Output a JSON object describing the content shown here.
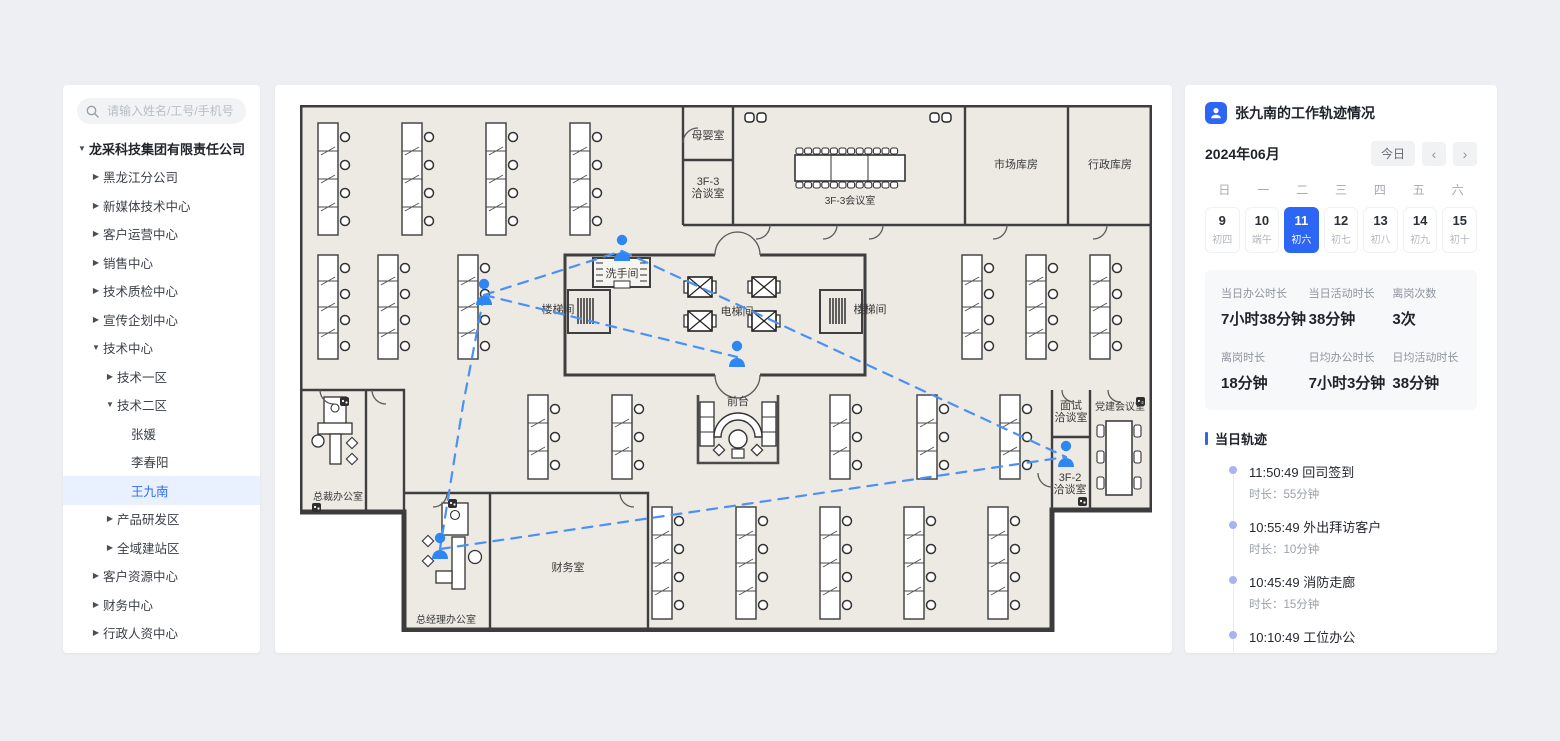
{
  "colors": {
    "accent": "#2d66f5",
    "path_blue": "#4a90f5",
    "marker_blue": "#2e86f2",
    "timeline_dot": "#a9b3f3",
    "floor_fill": "#eceae3",
    "wall": "#3c3c3c"
  },
  "sidebar": {
    "search_placeholder": "请输入姓名/工号/手机号",
    "tree": [
      {
        "label": "龙采科技集团有限责任公司",
        "level": 0,
        "state": "expanded",
        "selected": false
      },
      {
        "label": "黑龙江分公司",
        "level": 1,
        "state": "collapsed",
        "selected": false
      },
      {
        "label": "新媒体技术中心",
        "level": 1,
        "state": "collapsed",
        "selected": false
      },
      {
        "label": "客户运营中心",
        "level": 1,
        "state": "collapsed",
        "selected": false
      },
      {
        "label": "销售中心",
        "level": 1,
        "state": "collapsed",
        "selected": false
      },
      {
        "label": "技术质检中心",
        "level": 1,
        "state": "collapsed",
        "selected": false
      },
      {
        "label": "宣传企划中心",
        "level": 1,
        "state": "collapsed",
        "selected": false
      },
      {
        "label": "技术中心",
        "level": 1,
        "state": "expanded",
        "selected": false
      },
      {
        "label": "技术一区",
        "level": 2,
        "state": "collapsed",
        "selected": false
      },
      {
        "label": "技术二区",
        "level": 2,
        "state": "expanded",
        "selected": false
      },
      {
        "label": "张媛",
        "level": 3,
        "state": "leaf",
        "selected": false
      },
      {
        "label": "李春阳",
        "level": 3,
        "state": "leaf",
        "selected": false
      },
      {
        "label": "王九南",
        "level": 3,
        "state": "leaf",
        "selected": true
      },
      {
        "label": "产品研发区",
        "level": 2,
        "state": "collapsed",
        "selected": false
      },
      {
        "label": "全域建站区",
        "level": 2,
        "state": "collapsed",
        "selected": false
      },
      {
        "label": "客户资源中心",
        "level": 1,
        "state": "collapsed",
        "selected": false
      },
      {
        "label": "财务中心",
        "level": 1,
        "state": "collapsed",
        "selected": false
      },
      {
        "label": "行政人资中心",
        "level": 1,
        "state": "collapsed",
        "selected": false
      }
    ]
  },
  "floorplan": {
    "rooms": [
      {
        "label": "母婴室",
        "x": 408,
        "y": 34
      },
      {
        "label": "3F-3",
        "label2": "洽谈室",
        "x": 408,
        "y": 80
      },
      {
        "label": "3F-3会议室",
        "x": 550,
        "y": 99
      },
      {
        "label": "市场库房",
        "x": 716,
        "y": 63
      },
      {
        "label": "行政库房",
        "x": 810,
        "y": 63
      },
      {
        "label": "洗手间",
        "x": 322,
        "y": 172
      },
      {
        "label": "楼梯间",
        "x": 258,
        "y": 208
      },
      {
        "label": "电梯间",
        "x": 437,
        "y": 210
      },
      {
        "label": "楼梯间",
        "x": 570,
        "y": 208
      },
      {
        "label": "前台",
        "x": 438,
        "y": 300
      },
      {
        "label": "总裁办公室",
        "x": 38,
        "y": 395
      },
      {
        "label": "总经理办公室",
        "x": 146,
        "y": 518
      },
      {
        "label": "财务室",
        "x": 268,
        "y": 466
      },
      {
        "label": "面试",
        "label2": "洽谈室",
        "x": 771,
        "y": 304
      },
      {
        "label": "党建会议室",
        "x": 820,
        "y": 305
      },
      {
        "label": "3F-2",
        "label2": "洽谈室",
        "x": 770,
        "y": 376
      }
    ],
    "trajectory": {
      "points": {
        "A": {
          "x": 184,
          "y": 190
        },
        "B": {
          "x": 322,
          "y": 146
        },
        "C": {
          "x": 437,
          "y": 252
        },
        "D": {
          "x": 140,
          "y": 444
        },
        "E": {
          "x": 766,
          "y": 352
        }
      },
      "segments": [
        {
          "from": "A",
          "to": "B"
        },
        {
          "from": "B",
          "to": "E"
        },
        {
          "from": "A",
          "to": "C"
        },
        {
          "from": "A",
          "to": "D",
          "via": [
            [
              163,
              300
            ]
          ]
        },
        {
          "from": "D",
          "to": "E"
        }
      ]
    }
  },
  "panel": {
    "title": "张九南的工作轨迹情况",
    "month": "2024年06月",
    "today_label": "今日",
    "prev_label": "‹",
    "next_label": "›",
    "weekdays": [
      "日",
      "一",
      "二",
      "三",
      "四",
      "五",
      "六"
    ],
    "dates": [
      {
        "day": "9",
        "lunar": "初四",
        "selected": false
      },
      {
        "day": "10",
        "lunar": "端午",
        "selected": false
      },
      {
        "day": "11",
        "lunar": "初六",
        "selected": true
      },
      {
        "day": "12",
        "lunar": "初七",
        "selected": false
      },
      {
        "day": "13",
        "lunar": "初八",
        "selected": false
      },
      {
        "day": "14",
        "lunar": "初九",
        "selected": false
      },
      {
        "day": "15",
        "lunar": "初十",
        "selected": false
      }
    ],
    "stats": [
      {
        "label": "当日办公时长",
        "value": "7小时38分钟"
      },
      {
        "label": "当日活动时长",
        "value": "38分钟"
      },
      {
        "label": "离岗次数",
        "value": "3次"
      },
      {
        "label": "离岗时长",
        "value": "18分钟"
      },
      {
        "label": "日均办公时长",
        "value": "7小时3分钟"
      },
      {
        "label": "日均活动时长",
        "value": "38分钟"
      }
    ],
    "track_title": "当日轨迹",
    "events": [
      {
        "time": "11:50:49",
        "place": "回司签到",
        "duration": "时长：55分钟"
      },
      {
        "time": "10:55:49",
        "place": "外出拜访客户",
        "duration": "时长：10分钟"
      },
      {
        "time": "10:45:49",
        "place": "消防走廊",
        "duration": "时长：15分钟"
      },
      {
        "time": "10:10:49",
        "place": "工位办公",
        "duration": "时长：20分钟"
      },
      {
        "time": "09:50:49",
        "place": "会议室",
        "duration": "时长：48分钟"
      }
    ]
  }
}
